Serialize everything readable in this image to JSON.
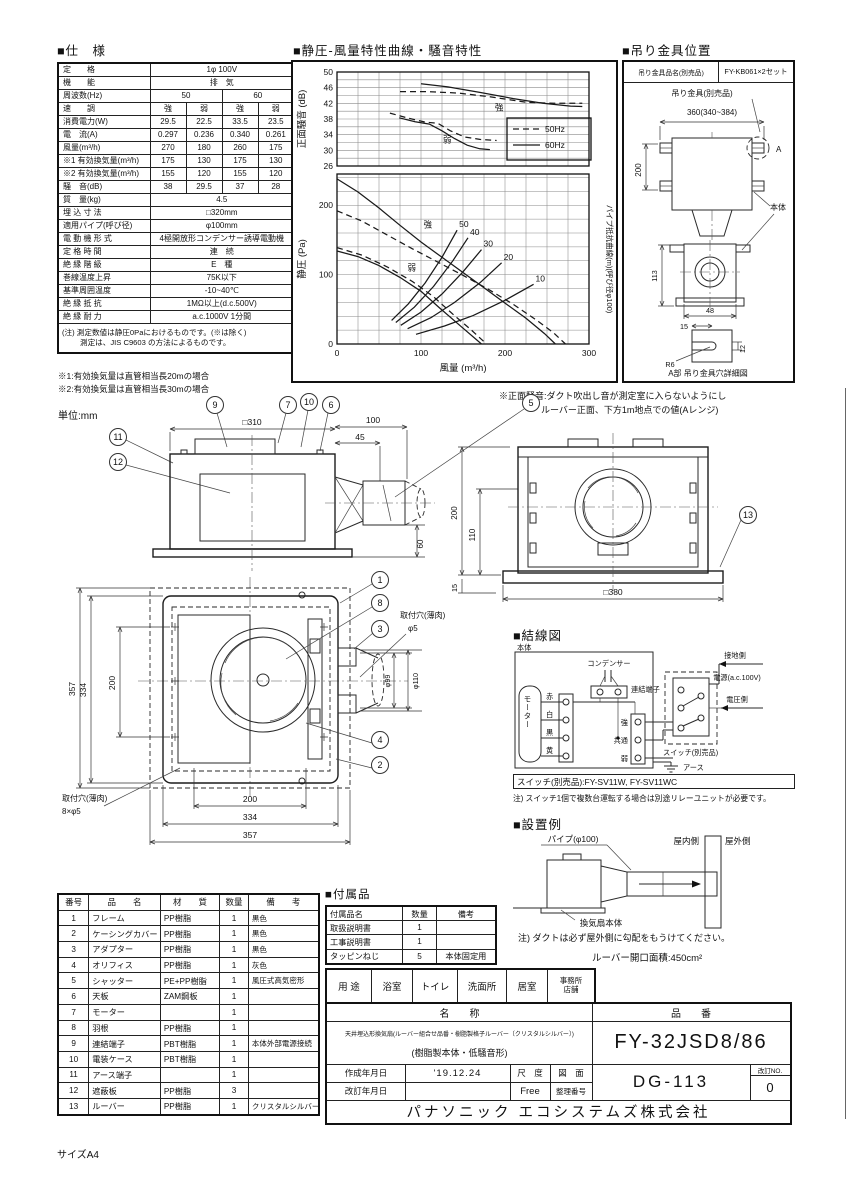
{
  "sheet": {
    "size_label": "サイズA4"
  },
  "spec": {
    "section_title": "■仕　様",
    "rows2": [
      {
        "label": "定　　格",
        "value": "1φ 100V"
      },
      {
        "label": "機　　能",
        "value": "排　気"
      }
    ],
    "freq_row": {
      "label": "周波数(Hz)",
      "v1": "50",
      "v2": "60"
    },
    "quad_rows": [
      {
        "label": "速　　調",
        "v": [
          "強",
          "弱",
          "強",
          "弱"
        ]
      },
      {
        "label": "消費電力(W)",
        "v": [
          "29.5",
          "22.5",
          "33.5",
          "23.5"
        ]
      },
      {
        "label": "電　流(A)",
        "v": [
          "0.297",
          "0.236",
          "0.340",
          "0.261"
        ]
      },
      {
        "label": "風量(m³/h)",
        "v": [
          "270",
          "180",
          "260",
          "175"
        ]
      },
      {
        "label": "※1 有効換気量(m³/h)",
        "v": [
          "175",
          "130",
          "175",
          "130"
        ]
      },
      {
        "label": "※2 有効換気量(m³/h)",
        "v": [
          "155",
          "120",
          "155",
          "120"
        ]
      },
      {
        "label": "騒　音(dB)",
        "v": [
          "38",
          "29.5",
          "37",
          "28"
        ]
      }
    ],
    "single_rows": [
      {
        "label": "質　量(kg)",
        "value": "4.5"
      },
      {
        "label": "埋 込 寸 法",
        "value": "□320mm"
      },
      {
        "label": "適用パイプ(呼び径)",
        "value": "φ100mm"
      },
      {
        "label": "電 動 機 形 式",
        "value": "4極開放形コンデンサー誘導電動機"
      },
      {
        "label": "定 格 時 間",
        "value": "連　続"
      },
      {
        "label": "絶 縁 階 級",
        "value": "E　種"
      },
      {
        "label": "巻線温度上昇",
        "value": "75K以下"
      },
      {
        "label": "基準周囲温度",
        "value": "-10~40℃"
      },
      {
        "label": "絶 縁 抵 抗",
        "value": "1MΩ以上(d.c.500V)"
      },
      {
        "label": "絶 縁 耐 力",
        "value": "a.c.1000V 1分間"
      }
    ],
    "note1": "(注) 測定数値は静圧0Paにおけるものです。(※は除く)",
    "note2": "測定は、JIS C9603 の方法によるものです。"
  },
  "footnotes": {
    "f1": "※1:有効換気量は直管相当長20mの場合",
    "f2": "※2:有効換気量は直管相当長30mの場合",
    "unit": "単位:mm"
  },
  "chart": {
    "section_title": "■静圧-風量特性曲線・騒音特性",
    "note1": "※正面騒音:ダクト吹出し音が測定室に入らないようにし",
    "note2": "ルーバー正面、下方1m地点での値(Aレンジ)"
  },
  "chart_data": {
    "type": "line",
    "title": "静圧-風量特性曲線・騒音特性",
    "x": {
      "label": "風量 (m³/h)",
      "min": 0,
      "max": 300,
      "ticks": [
        0,
        100,
        200,
        300
      ],
      "grid_step": 25
    },
    "noise": {
      "ylabel": "正面騒音 (dB)",
      "min": 26,
      "max": 50,
      "ticks": [
        26,
        30,
        34,
        38,
        42,
        46,
        50
      ],
      "grid_step": 2,
      "series": [
        {
          "name": "50Hz 強",
          "dash": true,
          "points": [
            [
              75,
              45
            ],
            [
              108,
              45
            ],
            [
              145,
              44.6
            ],
            [
              185,
              43.6
            ],
            [
              225,
              42.3
            ],
            [
              258,
              42
            ],
            [
              292,
              42
            ]
          ]
        },
        {
          "name": "60Hz 強",
          "dash": false,
          "points": [
            [
              100,
              47
            ],
            [
              132,
              46.2
            ],
            [
              170,
              44.8
            ],
            [
              210,
              43.2
            ],
            [
              245,
              42
            ],
            [
              278,
              41.3
            ],
            [
              292,
              41.2
            ]
          ]
        },
        {
          "name": "50Hz 弱",
          "dash": true,
          "points": [
            [
              63,
              39.5
            ],
            [
              85,
              38.2
            ],
            [
              105,
              37.2
            ],
            [
              120,
              36.9
            ],
            [
              135,
              35
            ],
            [
              152,
              33.4
            ],
            [
              170,
              32.8
            ],
            [
              190,
              32.5
            ]
          ]
        },
        {
          "name": "60Hz 弱",
          "dash": false,
          "points": [
            [
              74,
              38.3
            ],
            [
              93,
              37.3
            ],
            [
              110,
              36.7
            ],
            [
              125,
              35
            ],
            [
              140,
              33
            ],
            [
              155,
              31.3
            ],
            [
              170,
              30.4
            ],
            [
              182,
              30.2
            ]
          ]
        }
      ],
      "labels": [
        {
          "t": "強",
          "x": 188,
          "y": 40.2
        },
        {
          "t": "弱",
          "x": 126,
          "y": 32
        }
      ],
      "legend": [
        {
          "label": "50Hz",
          "dash": true
        },
        {
          "label": "60Hz",
          "dash": false
        }
      ]
    },
    "pressure": {
      "ylabel": "静圧 (Pa)",
      "right_label": "パイプ抵抗曲線(m)(呼び径φ100)",
      "min": 0,
      "max": 245,
      "ticks": [
        0,
        100,
        200
      ],
      "grid_step": 20,
      "fan_series": [
        {
          "name": "50Hz 強",
          "dash": true,
          "points": [
            [
              0,
              192
            ],
            [
              30,
              177
            ],
            [
              60,
              157
            ],
            [
              90,
              137
            ],
            [
              120,
              118
            ],
            [
              150,
              99
            ],
            [
              180,
              79
            ],
            [
              210,
              57
            ],
            [
              238,
              34
            ],
            [
              258,
              16
            ],
            [
              272,
              0
            ]
          ]
        },
        {
          "name": "60Hz 強",
          "dash": false,
          "points": [
            [
              0,
              238
            ],
            [
              25,
              219
            ],
            [
              50,
              196
            ],
            [
              75,
              171
            ],
            [
              100,
              147
            ],
            [
              125,
              125
            ],
            [
              150,
              103
            ],
            [
              175,
              81
            ],
            [
              200,
              59
            ],
            [
              225,
              37
            ],
            [
              247,
              15
            ],
            [
              260,
              0
            ]
          ]
        },
        {
          "name": "50Hz 弱",
          "dash": true,
          "points": [
            [
              0,
              139
            ],
            [
              30,
              128
            ],
            [
              60,
              111
            ],
            [
              90,
              90
            ],
            [
              115,
              68
            ],
            [
              138,
              43
            ],
            [
              160,
              20
            ],
            [
              178,
              0
            ]
          ]
        },
        {
          "name": "60Hz 弱",
          "dash": false,
          "points": [
            [
              0,
              134
            ],
            [
              25,
              126
            ],
            [
              50,
              113
            ],
            [
              75,
              96
            ],
            [
              100,
              76
            ],
            [
              122,
              52
            ],
            [
              148,
              25
            ],
            [
              172,
              0
            ]
          ]
        }
      ],
      "pipe_series": [
        {
          "label": "50",
          "points": [
            [
              65,
              34
            ],
            [
              85,
              58
            ],
            [
              105,
              88
            ],
            [
              125,
              125
            ],
            [
              143,
              164
            ]
          ]
        },
        {
          "label": "40",
          "points": [
            [
              70,
              31
            ],
            [
              92,
              53
            ],
            [
              115,
              83
            ],
            [
              138,
              120
            ],
            [
              156,
              153
            ]
          ]
        },
        {
          "label": "30",
          "points": [
            [
              76,
              27
            ],
            [
              100,
              46
            ],
            [
              125,
              72
            ],
            [
              150,
              104
            ],
            [
              172,
              136
            ]
          ]
        },
        {
          "label": "20",
          "points": [
            [
              84,
              22
            ],
            [
              112,
              38
            ],
            [
              140,
              60
            ],
            [
              170,
              88
            ],
            [
              196,
              117
            ]
          ]
        },
        {
          "label": "10",
          "points": [
            [
              94,
              14
            ],
            [
              128,
              26
            ],
            [
              162,
              41
            ],
            [
              200,
              63
            ],
            [
              234,
              86
            ]
          ]
        }
      ],
      "labels": [
        {
          "t": "強",
          "x": 103,
          "y": 168
        },
        {
          "t": "弱",
          "x": 84,
          "y": 106
        }
      ]
    }
  },
  "hanging": {
    "section_title": "■吊り金具位置",
    "part_label": "吊り金具品名(別売品)",
    "part_no": "FY-KB061×2セット",
    "bracket_label": "吊り金具(別売品)",
    "dim_200": "200",
    "dim_360": "360(340~384)",
    "a_mark": "A",
    "body_label": "本体",
    "dim_113": "113",
    "dim_48": "48",
    "dim_15": "15",
    "dim_12": "12",
    "r6": "R6",
    "caption": "A部 吊り金具穴詳細図"
  },
  "drawings": {
    "side_view": {
      "dim_w": "□310",
      "dim_100": "100",
      "dim_45": "45",
      "dim_60": "60",
      "c9": "9",
      "c7": "7",
      "c10": "10",
      "c6": "6",
      "c5": "5",
      "c11": "11",
      "c12": "12"
    },
    "rear_view": {
      "dim_200": "200",
      "dim_110": "110",
      "dim_15": "15",
      "dim_w": "□380",
      "c13": "13"
    },
    "bottom_view": {
      "dim_v357": "357",
      "dim_v334": "334",
      "dim_v200": "200",
      "dim_b200": "200",
      "dim_b334": "334",
      "dim_b357": "357",
      "dim_phi99": "φ99",
      "dim_phi110": "φ110",
      "hole_tr1": "取付穴(薄肉)",
      "hole_tr2": "φ5",
      "hole_bl1": "取付穴(薄肉)",
      "hole_bl2": "8×φ5",
      "c1": "1",
      "c8": "8",
      "c3": "3",
      "c4": "4",
      "c2": "2"
    }
  },
  "wiring": {
    "section_title": "■結線図",
    "body": "本体",
    "motor": "モーター",
    "wire_red": "赤",
    "wire_white": "白",
    "wire_black": "黒",
    "wire_yellow": "黄",
    "capacitor": "コンデンサー",
    "terminal": "連結端子",
    "strong": "強",
    "common": "共通",
    "weak": "弱",
    "ground_side": "接地側",
    "power": "電源(a.c.100V)",
    "voltage_side": "電圧側",
    "switch_label": "スイッチ(別売品)",
    "earth": "アース",
    "switch_models": "スイッチ(別売品):FY-SV11W, FY-SV11WC",
    "note": "注) スイッチ1個で複数台運転する場合は別途リレーユニットが必要です。"
  },
  "installation": {
    "section_title": "■設置例",
    "pipe": "パイプ(φ100)",
    "indoor": "屋内側",
    "outdoor": "屋外側",
    "fan_body": "換気扇本体",
    "note": "注) ダクトは必ず屋外側に勾配をもうけてください。",
    "louver_area": "ルーバー開口面積:450cm²"
  },
  "parts": {
    "headers": [
      "番号",
      "品　　名",
      "材　　質",
      "数量",
      "備　　考"
    ],
    "rows": [
      [
        "1",
        "フレーム",
        "PP樹脂",
        "1",
        "黒色"
      ],
      [
        "2",
        "ケーシングカバー",
        "PP樹脂",
        "1",
        "黒色"
      ],
      [
        "3",
        "アダプター",
        "PP樹脂",
        "1",
        "黒色"
      ],
      [
        "4",
        "オリフィス",
        "PP樹脂",
        "1",
        "灰色"
      ],
      [
        "5",
        "シャッター",
        "PE+PP樹脂",
        "1",
        "風圧式高気密形"
      ],
      [
        "6",
        "天板",
        "ZAM鋼板",
        "1",
        ""
      ],
      [
        "7",
        "モーター",
        "",
        "1",
        ""
      ],
      [
        "8",
        "羽根",
        "PP樹脂",
        "1",
        ""
      ],
      [
        "9",
        "連結端子",
        "PBT樹脂",
        "1",
        "本体外部電源接続"
      ],
      [
        "10",
        "電装ケース",
        "PBT樹脂",
        "1",
        ""
      ],
      [
        "11",
        "アース端子",
        "",
        "1",
        ""
      ],
      [
        "12",
        "遮蔽板",
        "PP樹脂",
        "3",
        ""
      ],
      [
        "13",
        "ルーバー",
        "PP樹脂",
        "1",
        "クリスタルシルバー"
      ]
    ]
  },
  "accessories": {
    "section_title": "■付属品",
    "headers": [
      "付属品名",
      "数量",
      "備考"
    ],
    "rows": [
      [
        "取扱説明書",
        "1",
        ""
      ],
      [
        "工事説明書",
        "1",
        ""
      ],
      [
        "タッピンねじ",
        "5",
        "本体固定用"
      ]
    ]
  },
  "usage": {
    "label": "用 途",
    "items": [
      "浴室",
      "トイレ",
      "洗面所",
      "居室"
    ],
    "office1": "事務所",
    "office2": "店舗"
  },
  "titleblock": {
    "name_header": "名　　称",
    "model_header": "品　　番",
    "name_line1": "天井埋込形換気扇(ルーバー組合せ品番・樹脂製格子ルーバー〔クリスタルシルバー〕)",
    "name_line2": "(樹脂製本体・低騒音形)",
    "model": "FY-32JSD8/86",
    "created_label": "作成年月日",
    "created_value": "'19.12.24",
    "revised_label": "改訂年月日",
    "revised_value": "",
    "scale_label": "尺　度",
    "scale_value": "Free",
    "drawing_label": "図　面",
    "number_label": "整理番号",
    "drawing_no": "DG-113",
    "rev_label": "改訂NO.",
    "rev_value": "0",
    "company": "パナソニック エコシステムズ株式会社"
  }
}
